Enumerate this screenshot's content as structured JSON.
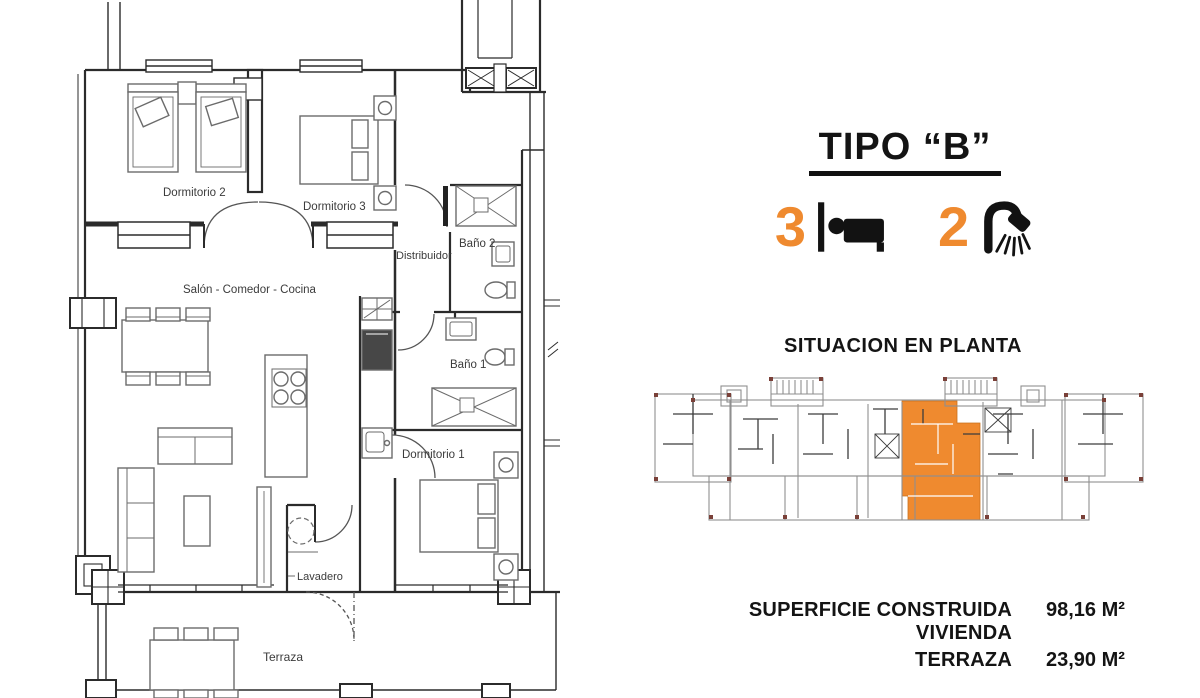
{
  "colors": {
    "accent": "#EF8A2F",
    "ink": "#141414",
    "wall": "#2b2b2b",
    "soft": "#6b6b6b",
    "label": "#3b3b3b",
    "site": "#8f8f8f",
    "sitedark": "#3c3c3c",
    "dot": "#7a4038"
  },
  "header": {
    "title": "TIPO “B”"
  },
  "features": {
    "bedrooms": {
      "count": "3",
      "icon": "bed-icon"
    },
    "bathrooms": {
      "count": "2",
      "icon": "shower-icon"
    }
  },
  "location": {
    "heading": "SITUACION EN PLANTA"
  },
  "floorplan": {
    "rooms": {
      "dormitorio2": "Dormitorio 2",
      "dormitorio3": "Dormitorio 3",
      "bano2": "Baño 2",
      "distribuidor": "Distribuidor",
      "salon": "Salón - Comedor - Cocina",
      "bano1": "Baño 1",
      "dormitorio1": "Dormitorio 1",
      "lavadero": "Lavadero",
      "terraza": "Terraza"
    }
  },
  "surfaces": {
    "rows": [
      {
        "label": "SUPERFICIE CONSTRUIDA VIVIENDA",
        "value": "98,16 M²"
      },
      {
        "label": "TERRAZA",
        "value": "23,90 M²"
      }
    ]
  }
}
